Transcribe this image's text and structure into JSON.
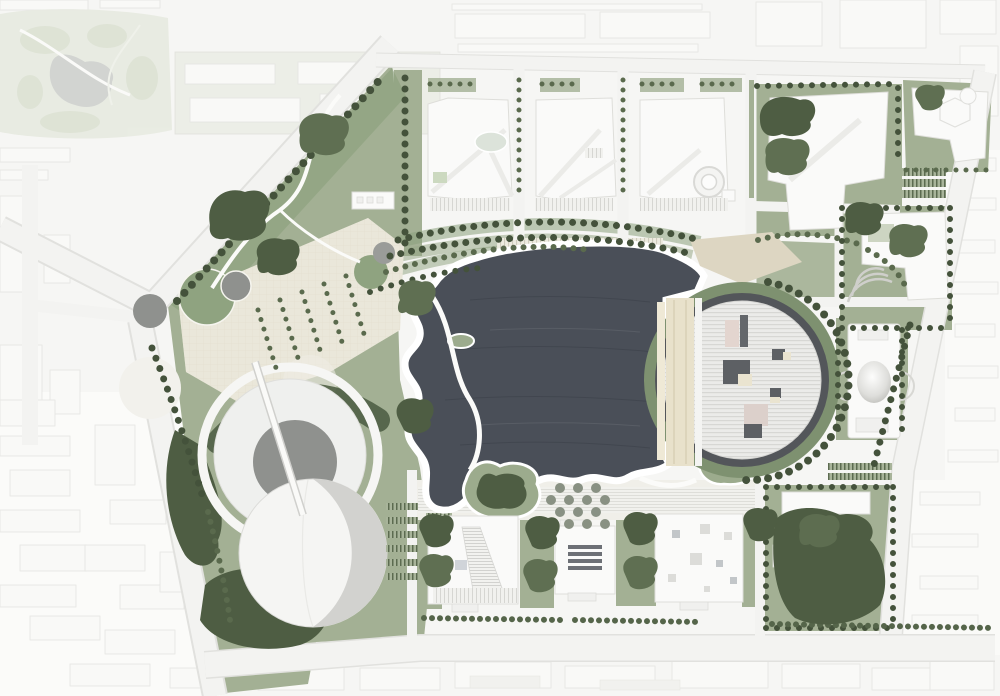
{
  "document": {
    "title": "Lakeside cultural district — architectural master plan (aerial site plan)",
    "description": "Rendered top-view master plan: a dark central lake edged by a white shore, a large circular hall with striped roof and lakeside terrace on the east, a circular amphitheater plaza with crescent shell pavilion on the southwest, three development blocks along the north boulevard, three gallery blocks on the south promenade, a domed pavilion on the east, tree-lined boulevards, and faded existing city fabric and park around the site."
  },
  "palette": {
    "background": "#f6f6f4",
    "context_fill": "#f9f9f7",
    "context_line": "#e4e4e1",
    "faded_park": "#e8ebe2",
    "faded_pond": "#d1d3d0",
    "road": "#f3f3f1",
    "road_edge": "#e1e1de",
    "lawn": "#a3b094",
    "lawn_dark": "#8ba07c",
    "tree_dark": "#49583f",
    "tree_mid": "#5d6d50",
    "plaza_cream": "#eae7da",
    "plaza_tan": "#ddd6c2",
    "terrace_tan": "#e8e1cb",
    "lake": "#4a4f58",
    "lake_deep": "#3a3f47",
    "shore": "#ffffff",
    "building": "#fafaf9",
    "roof_stripe": "#d7d7d4",
    "roof_block": "#5d6064",
    "roof_block_tan": "#eae4d0",
    "canopy_dark": "#53565a",
    "circle_gray": "#8f918e",
    "amphitheater_gray": "#8f918e"
  },
  "features": {
    "lake": "central lake with wavy west shoreline and small green island",
    "grand_hall": "circular hall, striped roof, rooftop volumes, tan lakeside terrace, dark canopy crescent, green ring",
    "amphitheater_plaza": "circular plaza with gray sunken amphitheater and crossing pier ramp",
    "shell_pavilion": "white crescent shell building south of the amphitheater plaza",
    "dome_pavilion": "rectangular pavilion with central dome, east edge of site",
    "north_blocks": "three white development blocks with diagonal paths, oval pond and ring courtyard",
    "south_galleries": "three gallery blocks: hatched ramp roof, grid skylights, scattered skylights",
    "tree_grid_plaza": "diamond grid of trees on south promenade",
    "promenade": "arcing tree rows and terraced steps north of the lake",
    "west_plaza": "cream plaza with gray and green circles and diagonal tree rows",
    "existing_park": "faded existing park with pond, top-left",
    "city_context": "faded surrounding city blocks and road grid"
  }
}
